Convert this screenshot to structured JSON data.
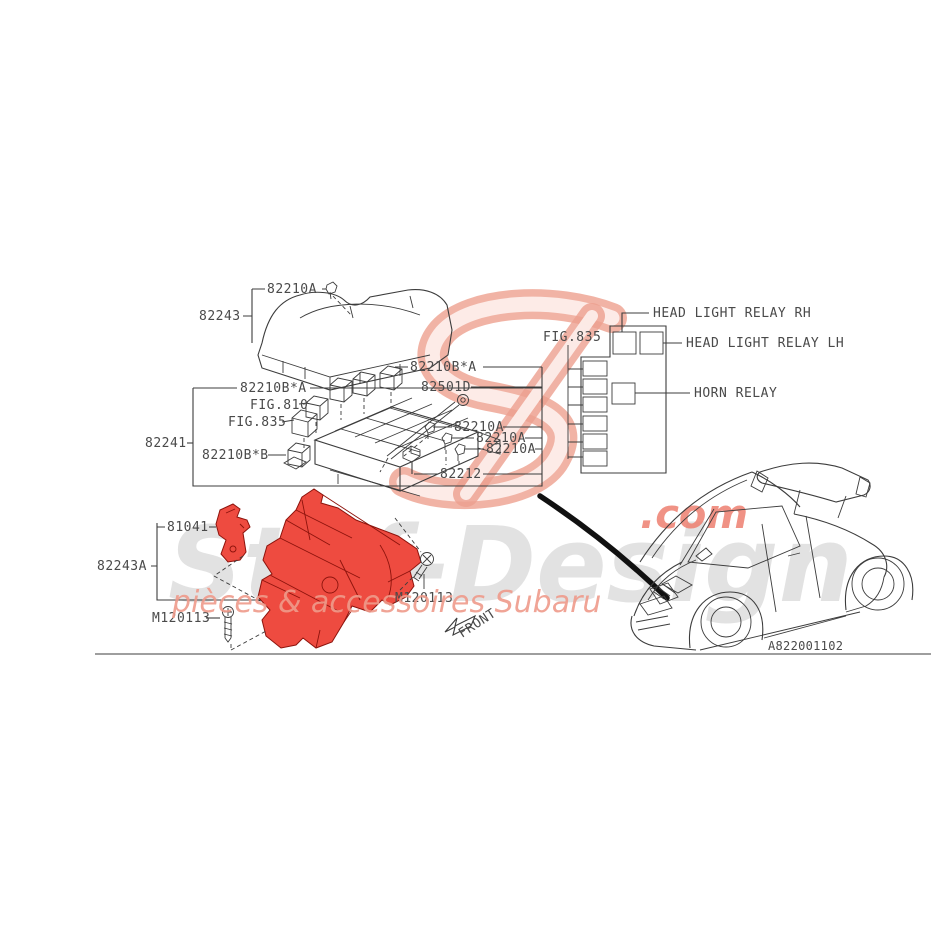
{
  "watermark": {
    "brand": "Stef-Design",
    "tld": ".com",
    "tagline": "pièces & accessoires Subaru"
  },
  "footer": {
    "drawing_code": "A822001102"
  },
  "orientation": {
    "front_label": "FRONT"
  },
  "cover_group": {
    "clip_label": "82210A",
    "cover_label": "82243"
  },
  "box_group": {
    "bracket_label": "82241",
    "relay_left_label": "82210B*A",
    "fig810_label": "FIG.810",
    "fig835_label": "FIG.835",
    "relay_b_label": "82210B*B",
    "relay_right_label": "82210B*A",
    "bolt_label": "82501D",
    "clip1_label": "82210A",
    "clip2_label": "82210A",
    "clip3_label": "82210A",
    "bracket82212_label": "82212"
  },
  "schematic": {
    "fig_label": "FIG.835",
    "headlight_rh_label": "HEAD LIGHT RELAY RH",
    "headlight_lh_label": "HEAD LIGHT RELAY LH",
    "horn_label": "HORN RELAY"
  },
  "mount_group": {
    "stay_label": "81041",
    "holder_label": "82243A",
    "screw_left_label": "M120113",
    "screw_right_label": "M120113"
  },
  "colors": {
    "highlight_red": "#ee4b40",
    "line": "#3c3c3c",
    "label_text": "#4a4a4a",
    "watermark_gray": "#cbcbcb",
    "watermark_salmon": "#efa191",
    "watermark_red": "#ee8070"
  }
}
